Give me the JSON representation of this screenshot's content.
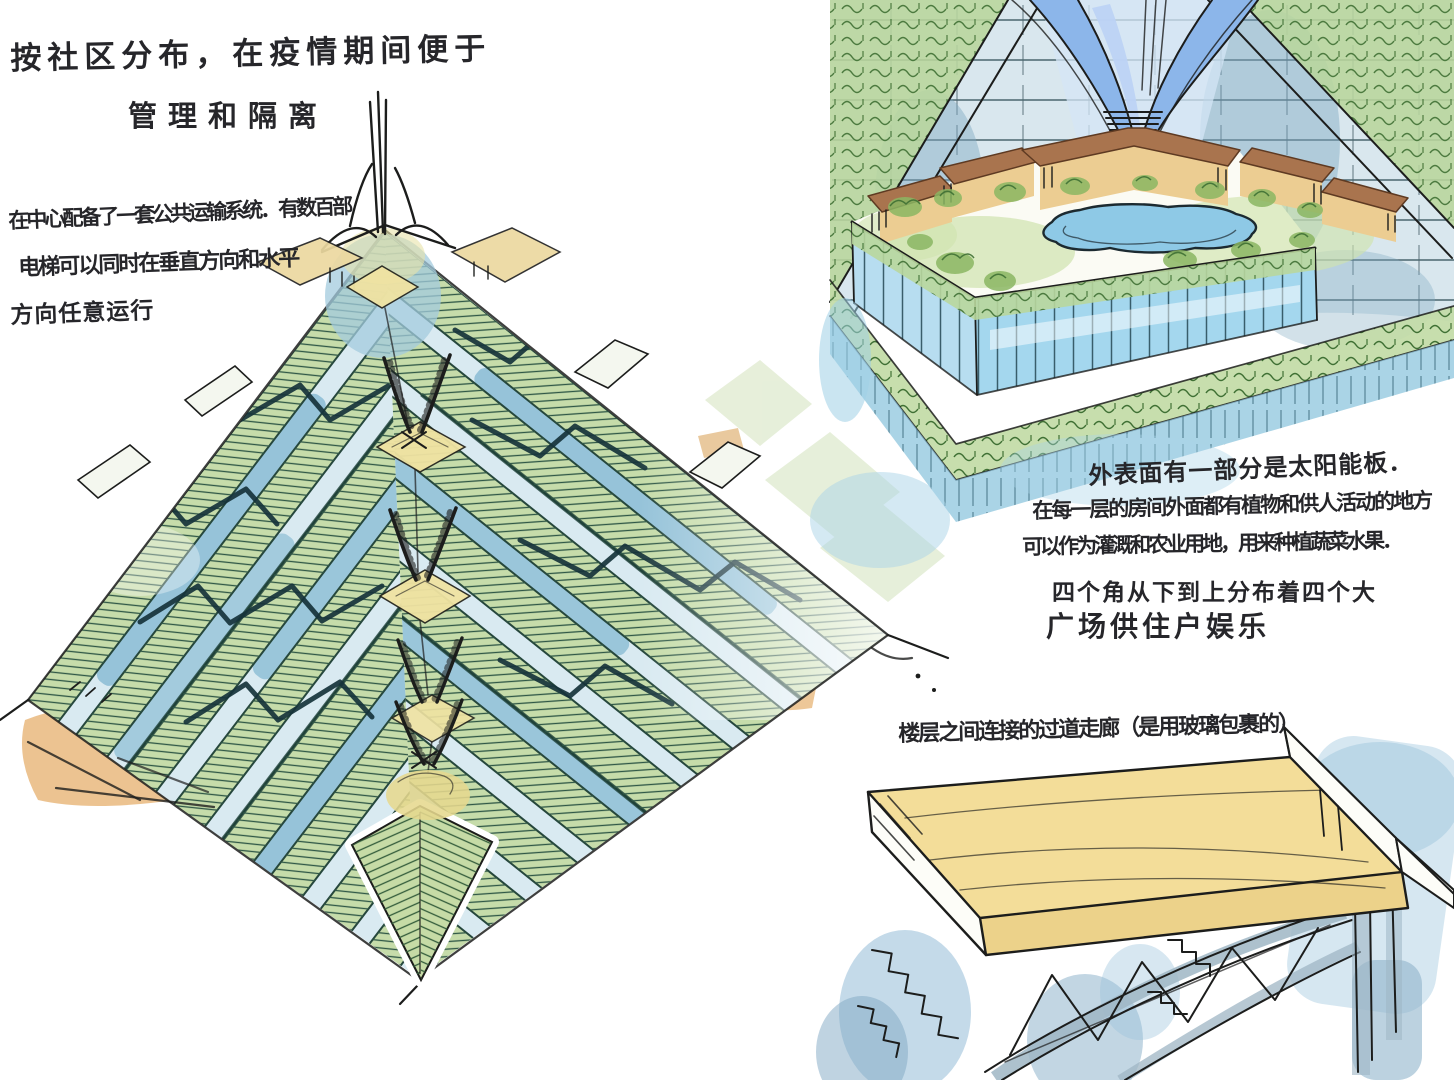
{
  "annotations": {
    "top_left": {
      "line1": "按社区分布，在疫情期间便于",
      "line2": "管理和隔离"
    },
    "transport_note": {
      "line1": "在中心配备了一套公共运输系统．有数百部",
      "line2": "电梯可以同时在垂直方向和水平",
      "line3": "方向任意运行"
    },
    "surface_note": {
      "line1": "外表面有一部分是太阳能板．",
      "line2": "在每一层的房间外面都有植物和供人活动的地方",
      "line3": "可以作为灌溉和农业用地，用来种植蔬菜水果．",
      "line4": "四个角从下到上分布着四个大",
      "line5": "广场供住户娱乐"
    },
    "bridge_note": {
      "line1": "楼层之间连接的过道走廊（是用玻璃包裹的）"
    }
  },
  "figures": {
    "pyramid": "pyramid-tower-sketch",
    "module": "garden-courtyard-module-sketch",
    "bridge": "glass-corridor-bridge-sketch"
  },
  "colors": {
    "bg": "#ffffff",
    "ink": "#26262a",
    "teal-ink": "#16333b",
    "hatch-green": "#2f5746",
    "green-strip": "#c6dcaa",
    "green-pale": "#cfe0b6",
    "blue-face": "#d9eaf1",
    "blue-strip": "#a6cfdf",
    "blue-deep": "#7fb6d0",
    "yellow-plaza": "#f0e3a2",
    "tan-cap": "#ecd9a0",
    "orange-wash": "#e9b97e",
    "arch-blue": "#8cb6ea",
    "arch-blue-light": "#bdd3f4",
    "glass-blue": "#aed9ee",
    "glass-deep": "#62b4d8",
    "grid-ink": "#27454f",
    "bench-brown": "#a9744e",
    "bench-tan": "#eccd92",
    "pond-blue": "#8ec9e6",
    "pond-cyan": "#55bedc",
    "leaf": "#3f7034",
    "leaf-fill": "#8bb763",
    "slope-green": "#b8d69c",
    "rim-green": "#c2dba6",
    "deck-yellow": "#f3dd99",
    "deck-shadow": "#ecd28a",
    "truss-grey": "#9fb6c4",
    "wash-blue": "#a9cbe0"
  }
}
